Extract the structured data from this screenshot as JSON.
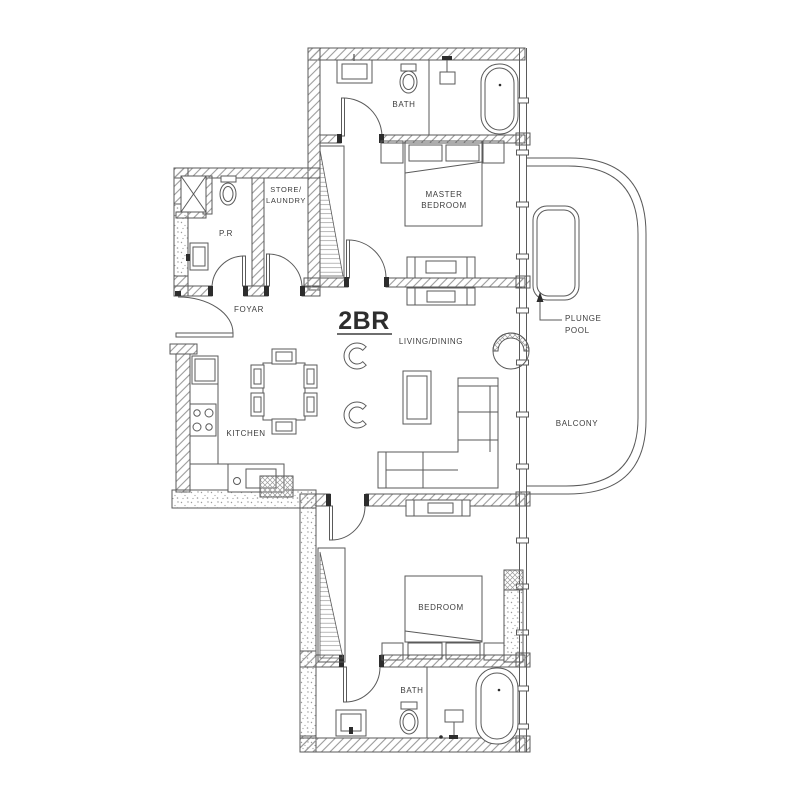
{
  "title": "2BR",
  "colors": {
    "line": "#5a5a5a",
    "hatch": "#9a9a9a",
    "text": "#3d3d3d",
    "dark": "#2d2d2d",
    "background": "#ffffff"
  },
  "labels": {
    "unit": "2BR",
    "bath_top": "BATH",
    "master_bedroom": [
      "MASTER",
      "BEDROOM"
    ],
    "store_laundry": [
      "STORE/",
      "LAUNDRY"
    ],
    "powder_room": "P.R",
    "foyer": "FOYAR",
    "living_dining": "LIVING/DINING",
    "kitchen": "KITCHEN",
    "plunge_pool": [
      "PLUNGE",
      "POOL"
    ],
    "balcony": "BALCONY",
    "bedroom": "BEDROOM",
    "bath_bottom": "BATH"
  }
}
